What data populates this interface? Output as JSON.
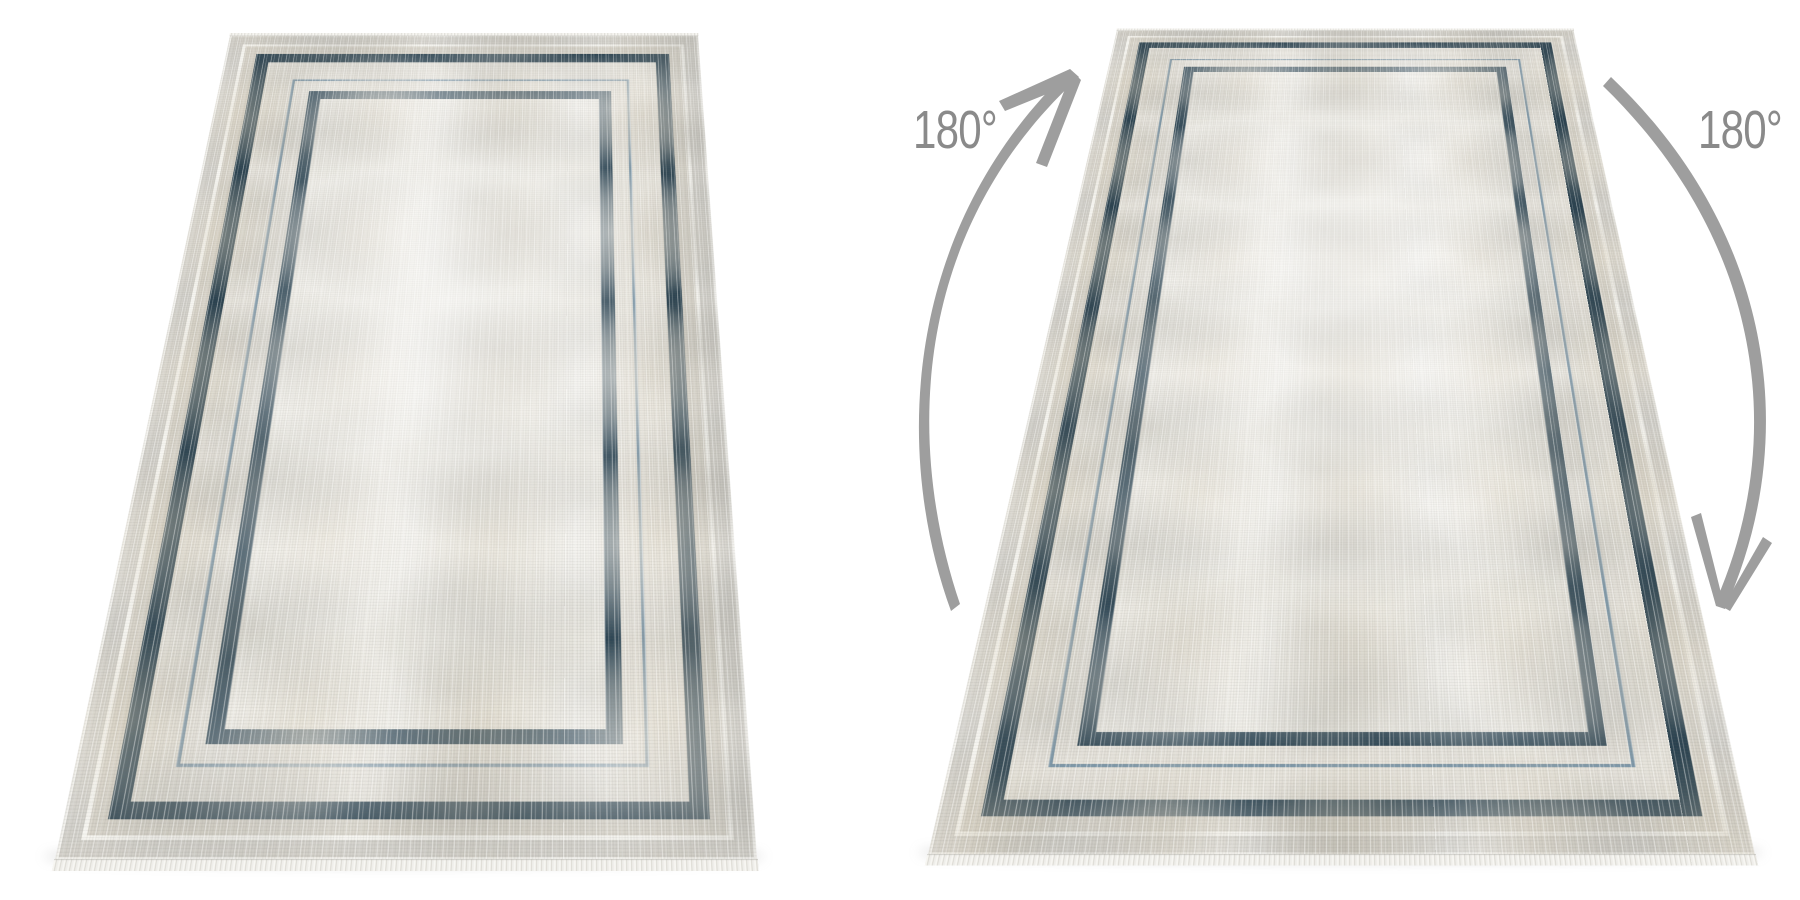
{
  "annotations": {
    "rotation_labels": [
      {
        "text": "180°",
        "position": "left"
      },
      {
        "text": "180°",
        "position": "right"
      }
    ],
    "arrows": [
      {
        "icon": "rotation-arrow-up",
        "direction": "curves up along left side of right rug"
      },
      {
        "icon": "rotation-arrow-down",
        "direction": "curves down along right side of right rug"
      }
    ]
  },
  "scene": {
    "subject": "two perspective views of the same cream rug with concentric navy frames",
    "right_view_note": "same rug rotated 180 degrees"
  },
  "colors": {
    "background": "#ffffff",
    "arrow": "#9e9e9e",
    "label_text": "#8a8a8a",
    "rug_field": "#eceae3",
    "rug_gray_band": "#d3d1cb",
    "rug_beige_band": "#d8d4ca",
    "rug_white_line": "#f7f6f1",
    "rug_navy_border": "#29414f",
    "rug_navy_inner": "#2b4453",
    "rug_steel_line": "#7e98a9",
    "rug_gap": "#e6e3db",
    "fringe": "#f3f2ee",
    "shadow": "#8f8f8f"
  }
}
